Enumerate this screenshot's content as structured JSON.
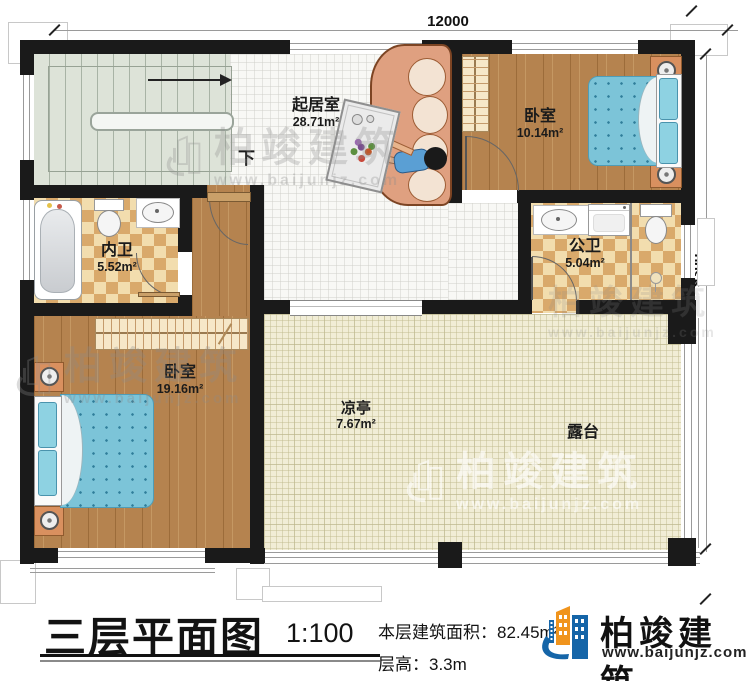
{
  "dimensions": {
    "width_label": "12000",
    "height_label": "9300"
  },
  "rooms": {
    "living": {
      "name": "起居室",
      "area": "28.71m²"
    },
    "bedroom_right": {
      "name": "卧室",
      "area": "10.14m²"
    },
    "bath_inner": {
      "name": "内卫",
      "area": "5.52m²"
    },
    "bath_public": {
      "name": "公卫",
      "area": "5.04m²"
    },
    "bedroom_left": {
      "name": "卧室",
      "area": "19.16m²"
    },
    "pavilion": {
      "name": "凉亭",
      "area": "7.67m²"
    },
    "terrace": {
      "name": "露台"
    },
    "stair_down": "下"
  },
  "watermark": {
    "brand": "柏竣建筑",
    "url": "www.baijunjz.com"
  },
  "title_block": {
    "plan_title": "三层平面图",
    "scale": "1:100",
    "area_text": "本层建筑面积：82.45m²",
    "floor_height_text": "层高：3.3m",
    "brand": "柏竣建筑",
    "brand_url": "www.baijunjz.com"
  },
  "colors": {
    "wall": "#1a1a1a",
    "wood": "#b5834f",
    "checker_dark": "#d9a96b",
    "checker_light": "#f2ddae",
    "stairs": "#dde3d8",
    "terrace": "#f1edd6",
    "bed_blue": "#7cc4d8",
    "sofa": "#dfa080",
    "logo_blue": "#1565a8",
    "logo_orange": "#f0941d"
  }
}
